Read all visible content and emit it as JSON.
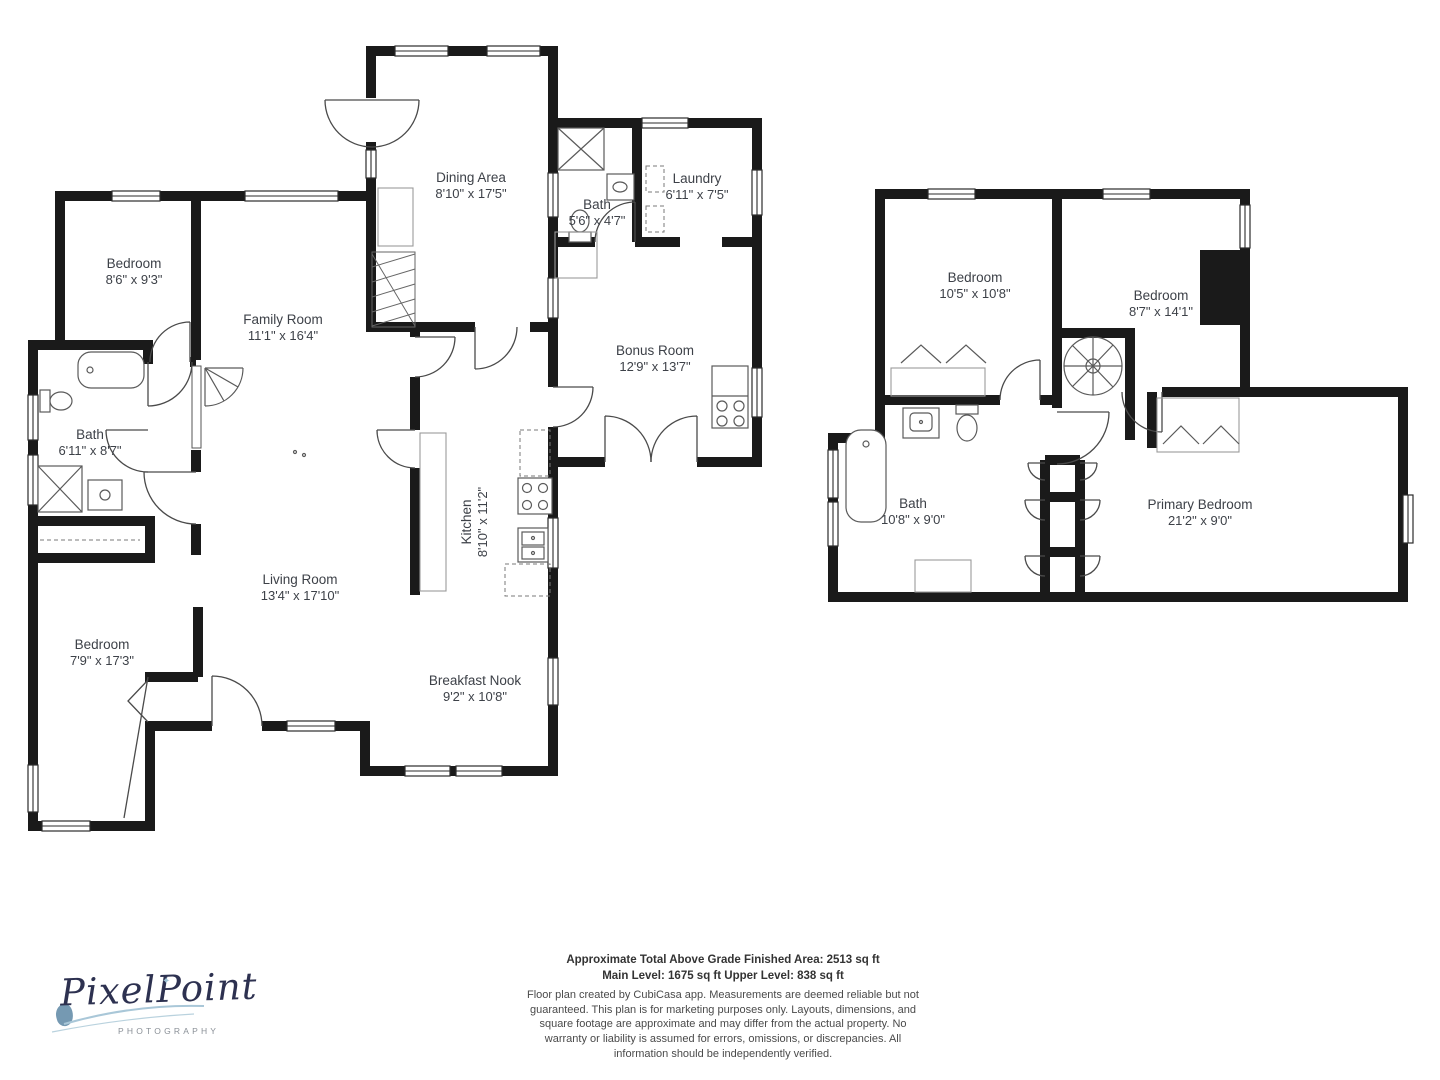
{
  "colors": {
    "wall": "#1a1a1a",
    "fixture_line": "#5a5a5a",
    "label_text": "#3d4148",
    "footer_text": "#333333",
    "logo_navy": "#2d3150",
    "logo_blue": "#9fc3d5",
    "logo_gray": "#8a9097"
  },
  "levels": {
    "main": {
      "rooms": [
        {
          "name": "Bedroom",
          "dims": "8'6\" x 9'3\""
        },
        {
          "name": "Family Room",
          "dims": "11'1\" x 16'4\""
        },
        {
          "name": "Dining Area",
          "dims": "8'10\" x 17'5\""
        },
        {
          "name": "Bath",
          "dims": "5'6\" x 4'7\""
        },
        {
          "name": "Laundry",
          "dims": "6'11\" x 7'5\""
        },
        {
          "name": "Bonus Room",
          "dims": "12'9\" x 13'7\""
        },
        {
          "name": "Bath",
          "dims": "6'11\" x 8'7\""
        },
        {
          "name": "Kitchen",
          "dims": "8'10\" x 11'2\""
        },
        {
          "name": "Living Room",
          "dims": "13'4\" x 17'10\""
        },
        {
          "name": "Bedroom",
          "dims": "7'9\" x 17'3\""
        },
        {
          "name": "Breakfast Nook",
          "dims": "9'2\" x 10'8\""
        }
      ]
    },
    "upper": {
      "rooms": [
        {
          "name": "Bedroom",
          "dims": "10'5\" x 10'8\""
        },
        {
          "name": "Bedroom",
          "dims": "8'7\" x 14'1\""
        },
        {
          "name": "Bath",
          "dims": "10'8\" x 9'0\""
        },
        {
          "name": "Primary Bedroom",
          "dims": "21'2\" x 9'0\""
        }
      ]
    }
  },
  "footer": {
    "line1": "Approximate Total Above Grade Finished Area: 2513 sq ft",
    "line2": "Main Level: 1675 sq ft  Upper Level: 838 sq ft",
    "disclaimer": "Floor plan created by CubiCasa app. Measurements are deemed reliable but not guaranteed. This plan is for marketing purposes only. Layouts, dimensions, and square footage are approximate and may differ from the actual property. No warranty or liability is assumed for errors, omissions, or discrepancies. All information should be independently verified."
  },
  "logo": {
    "brand": "PixelPoint",
    "subtitle": "PHOTOGRAPHY",
    "sparkle": "✦"
  }
}
